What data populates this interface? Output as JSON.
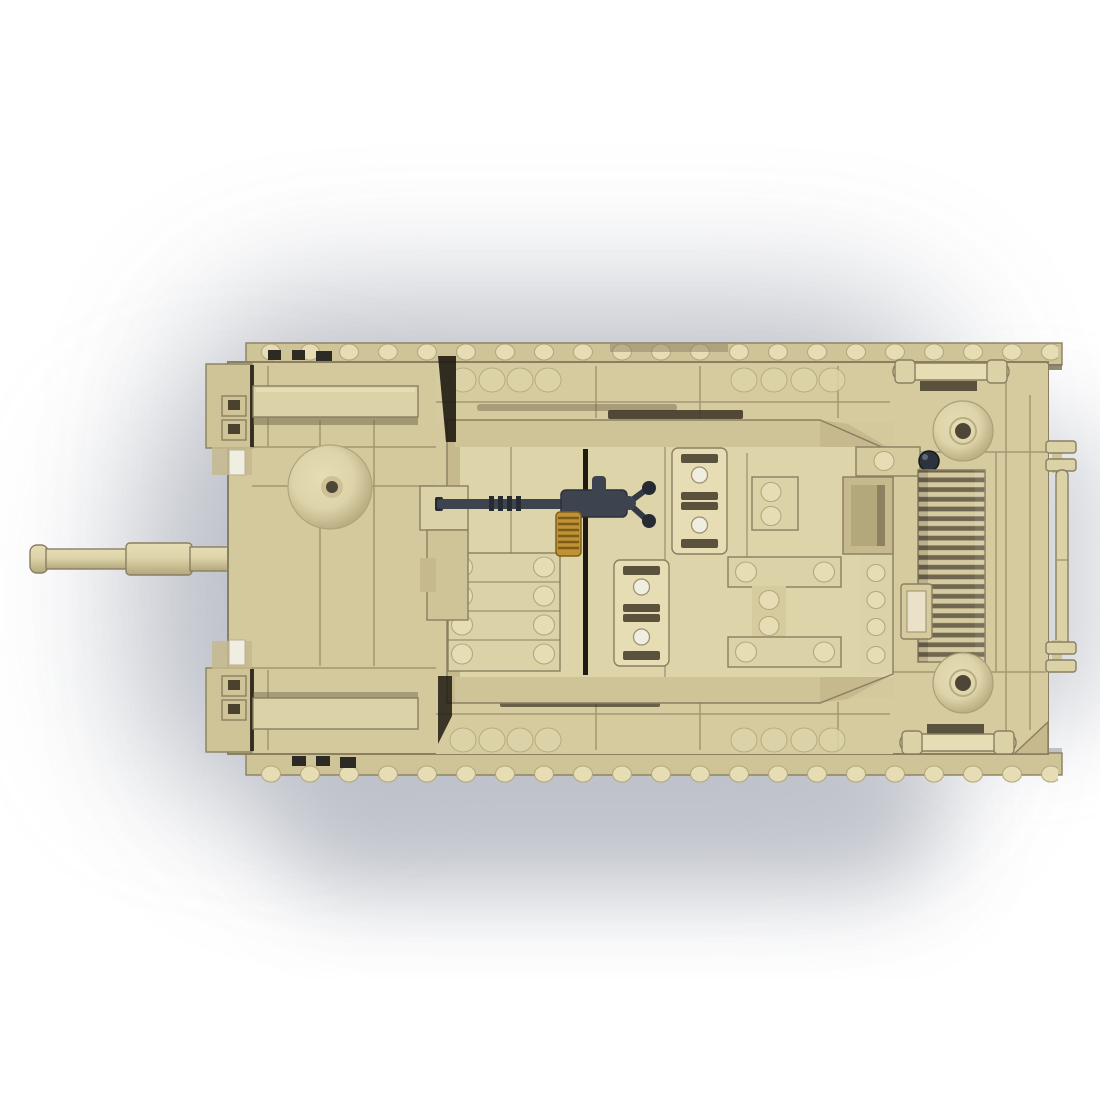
{
  "meta": {
    "title": "Brick-built assault-gun tank model — top view product render",
    "alt": "Top-down view of a sand-tan brick-built military tank (assault gun) model. A long tan cannon barrel points left, a dark gray anti-aircraft machine gun with a gold ammunition drum sits on the casemate roof, spare track links and stud plates decorate the deck, and the rear engine deck has a slatted grille, two round vent caps and a tow rail. White background with a soft gray shadow below and left of the model."
  },
  "palette": {
    "bg": "#ffffff",
    "shadow1": "#aeb2bc",
    "shadow2": "#b6bac3",
    "shadow3": "#c9ccd3",
    "tan_hull": "#d4c99d",
    "tan_base": "#d6cb9f",
    "tan_light": "#ded4aa",
    "tan_lighter": "#e7ddb5",
    "tan_plate": "#dcd2a8",
    "tan_band": "#cfc497",
    "tan_dark": "#c5b98d",
    "tan_deep": "#b3a77c",
    "edge": "#8a7f60",
    "crevice": "#6f6549",
    "slot": "#5a523c",
    "near_black": "#1f1b12",
    "hole": "#4e4636",
    "white_tile": "#f0ede1",
    "track_tile": "#2c2a22",
    "gun": "#3d4450",
    "gun_mid": "#4a5261",
    "gun_dark": "#262b33",
    "gold": "#bf9236",
    "gold_dark": "#7c5c16",
    "grille_dark": "#6f6750",
    "grille_slat": "#d5caa0",
    "steel_gap": "#9aa0ae"
  },
  "model": {
    "kind": "top-view brick tank render",
    "body_color_name": "sand tan",
    "parts": [
      {
        "name": "cannon-barrel",
        "label": "Long cannon barrel with muzzle cap and sleeve, pointing left"
      },
      {
        "name": "gun-mantlet",
        "label": "Stepped gun mantlet at casemate front"
      },
      {
        "name": "front-hatch-dome",
        "label": "Round dome hatch on front hull"
      },
      {
        "name": "front-beams",
        "label": "Two long rail beams on front hull"
      },
      {
        "name": "headlight-brackets",
        "label": "Front corner brackets with clear light tiles"
      },
      {
        "name": "track-runs",
        "label": "Upper and lower track runs with studs and dark tread tiles"
      },
      {
        "name": "casemate",
        "label": "Central fighting-compartment roof with center seam"
      },
      {
        "name": "engine-hatches",
        "label": "Hatch plates with corner studs on roof"
      },
      {
        "name": "spare-track-links",
        "label": "Spare track-link pieces stowed on roof and rear deck"
      },
      {
        "name": "machine-gun",
        "label": "Dark gray machine gun with gold ammo drum and twin-ball mount"
      },
      {
        "name": "stowage-recess",
        "label": "Open stowage box recess at roof rear"
      },
      {
        "name": "engine-grille",
        "label": "Slatted engine cooling grille on rear deck"
      },
      {
        "name": "vent-caps",
        "label": "Two round vent caps beside the grille"
      },
      {
        "name": "mushroom-knob",
        "label": "Small dark mushroom knob near grille"
      },
      {
        "name": "tow-rail",
        "label": "Rear tow rail with end brackets on right edge"
      }
    ]
  }
}
